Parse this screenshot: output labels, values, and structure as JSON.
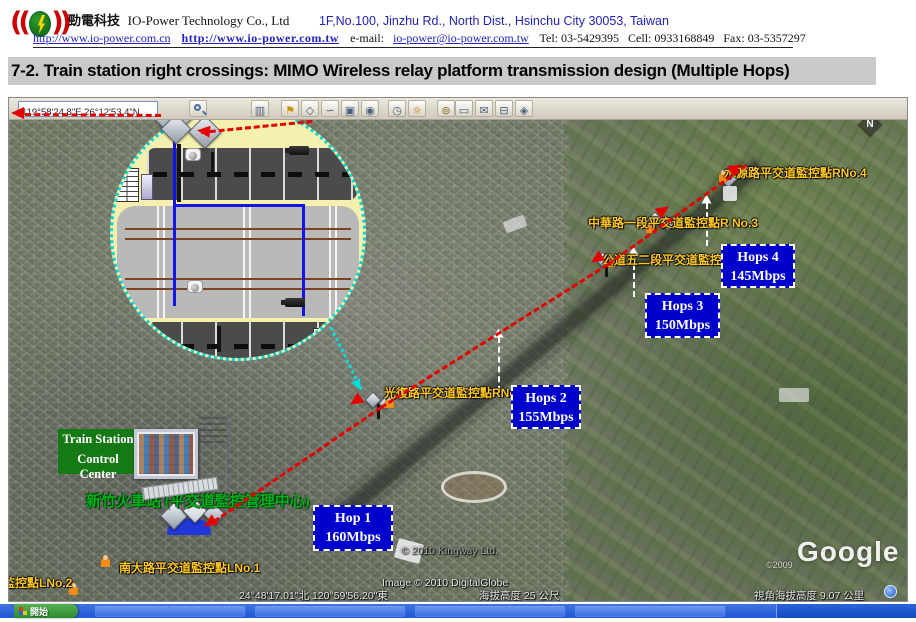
{
  "header": {
    "company_zh": "勁電科技",
    "company_en": "IO-Power Technology Co., Ltd",
    "address": "1F,No.100, Jinzhu Rd., North Dist.,  Hsinchu City 30053, Taiwan",
    "url_cn": "http://www.io-power.com.cn",
    "url_tw": "http://www.io-power.com.tw",
    "email_label": "e-mail:",
    "email": "io-power@io-power.com.tw",
    "tel": "Tel:  03-5429395",
    "cell": "Cell: 0933168849",
    "fax": "Fax: 03-5357297"
  },
  "title": "7-2. Train station right crossings: MIMO Wireless relay platform transmission design (Multiple Hops)",
  "map": {
    "search": {
      "value": "119°58'24.8\"E,26°12'53.4\"N"
    },
    "toolbar": {
      "icons": [
        {
          "name": "sidebar",
          "glyph": "▥"
        },
        {
          "name": "pushpin",
          "glyph": "⚑"
        },
        {
          "name": "polygon",
          "glyph": "◇"
        },
        {
          "name": "path",
          "glyph": "∽"
        },
        {
          "name": "image-overlay",
          "glyph": "▣"
        },
        {
          "name": "record-tour",
          "glyph": "◉"
        },
        {
          "name": "historical-imagery",
          "glyph": "◷"
        },
        {
          "name": "sunlight",
          "glyph": "☼"
        },
        {
          "name": "planets",
          "glyph": "⊚"
        },
        {
          "name": "ruler",
          "glyph": "▭"
        },
        {
          "name": "email",
          "glyph": "✉"
        },
        {
          "name": "print",
          "glyph": "⊟"
        },
        {
          "name": "view-in-maps",
          "glyph": "◈"
        }
      ]
    },
    "compass_label": "N",
    "control_center": {
      "line1": "Train Station",
      "line2": "Control Center"
    },
    "station_label": "新竹火車站 (平交道監控管理中心)",
    "points": {
      "l1": "南大路平交道監控點LNo.1",
      "l2": "監控點LNo.2",
      "r1": "光復路平交道監控點RNo.1",
      "r2": "公道五二段平交道監控點RNo.2",
      "r3": "中華路一段平交道監控點R No.3",
      "r4": "水源路平交道監控點RNo.4"
    },
    "hops": [
      {
        "label": "Hop 1",
        "rate": "160Mbps"
      },
      {
        "label": "Hops 2",
        "rate": "155Mbps"
      },
      {
        "label": "Hops 3",
        "rate": "150Mbps"
      },
      {
        "label": "Hops 4",
        "rate": "145Mbps"
      }
    ],
    "status": {
      "map_copyright": "© 2010 Kingway Ltd.",
      "imagery_credit": "Image © 2010 DigitalGlobe",
      "coordinates": "24°48'17.01\"北   120°59'56.20\"東",
      "elevation": "海拔高度   25 公尺",
      "eye_altitude": "視角海拔高度   9.07 公里",
      "google_copyright": "©2009",
      "google_logo": "Google"
    }
  },
  "taskbar": {
    "start_label": "開始"
  },
  "colors": {
    "accent_red": "#e60000",
    "hop_blue": "#0000cd",
    "highlight_yellow": "#f5f0ad",
    "cyan": "#00dcdc",
    "label_yellow": "#ffc81e",
    "green_box": "#157a15",
    "text_green": "#00b21e"
  }
}
